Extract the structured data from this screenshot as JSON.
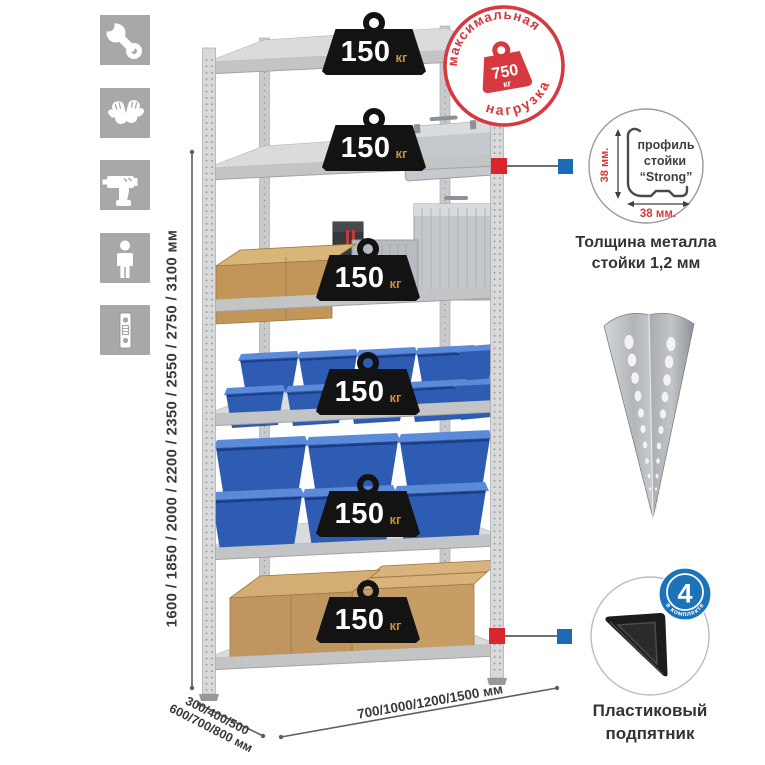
{
  "colors": {
    "accent_red": "#d6393f",
    "accent_blue": "#1c6cb5",
    "badge_black": "#131313",
    "icon_gray": "#a8a8a8",
    "bin_blue": "#2d5cb2",
    "kg_orange": "#cf8c3e",
    "metal_gray": "#d8d9db",
    "cardboard": "#c29658"
  },
  "left_icons": {
    "items": [
      {
        "name": "wrench-icon"
      },
      {
        "name": "gloves-icon"
      },
      {
        "name": "drill-icon"
      },
      {
        "name": "person-icon"
      },
      {
        "name": "rack-post-icon"
      }
    ]
  },
  "dimensions": {
    "height_label": "1600 / 1850 / 2000 / 2200 / 2350 / 2550 / 2750 / 3100 мм",
    "depth_line1": "300/400/500",
    "depth_line2": "600/700/800 мм",
    "width_label": "700/1000/1200/1500 мм"
  },
  "max_load_stamp": {
    "arc_top": "максимальная",
    "arc_bottom": "нагрузка",
    "value": "750",
    "unit": "кг"
  },
  "shelf_badges": [
    {
      "value": "150",
      "unit": "кг"
    },
    {
      "value": "150",
      "unit": "кг"
    },
    {
      "value": "150",
      "unit": "кг"
    },
    {
      "value": "150",
      "unit": "кг"
    },
    {
      "value": "150",
      "unit": "кг"
    },
    {
      "value": "150",
      "unit": "кг"
    }
  ],
  "profile_detail": {
    "line1": "профиль",
    "line2": "стойки",
    "line3": "“Strong”",
    "dim_vertical": "38 мм.",
    "dim_horizontal": "38 мм.",
    "caption_line1": "Толщина металла",
    "caption_line2": "стойки 1,2 мм"
  },
  "foot_detail": {
    "badge_value": "4",
    "badge_arc": "в комплекте",
    "caption_line1": "Пластиковый",
    "caption_line2": "подпятник"
  }
}
